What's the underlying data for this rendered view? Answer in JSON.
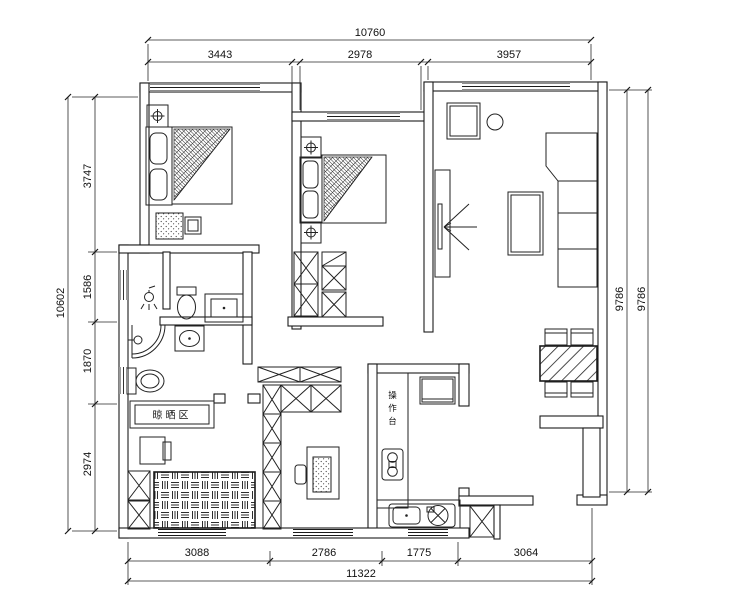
{
  "drawing": {
    "type": "residential floor plan",
    "dimensions_mm": {
      "top": {
        "total": "10760",
        "segments": [
          "3443",
          "2978",
          "3957"
        ]
      },
      "left": {
        "total": "10602",
        "segments": [
          "3747",
          "1586",
          "1870",
          "2974"
        ]
      },
      "right": {
        "lines": [
          "9786",
          "9786"
        ]
      },
      "bottom": {
        "total": "11322",
        "segments": [
          "3088",
          "2786",
          "1775",
          "3064"
        ]
      }
    },
    "room_labels": {
      "drying_area": "晾晒区",
      "kitchen_counter": "操作台"
    },
    "colors": {
      "line": "#1b1b1b",
      "background": "#ffffff"
    }
  }
}
